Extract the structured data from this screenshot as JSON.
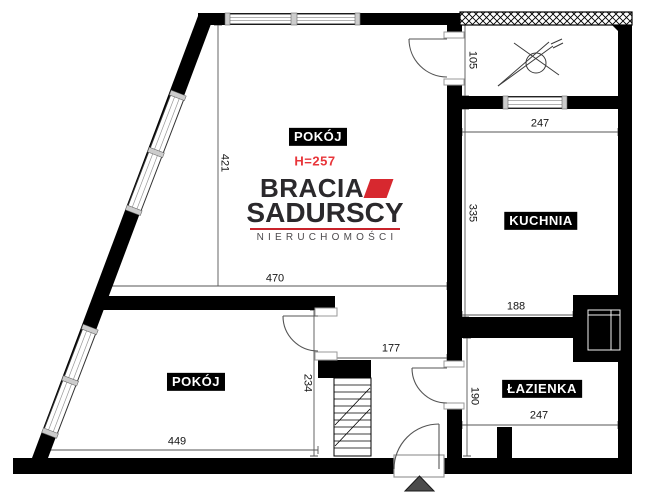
{
  "branding": {
    "line1": "BRACIA",
    "line2": "SADURSCY",
    "line3": "NIERUCHOMOŚCI"
  },
  "room_labels": {
    "room_top": "POKÓJ",
    "room_top_height_note": "H=257",
    "kitchen": "KUCHNIA",
    "bathroom": "ŁAZIENKA",
    "room_bottom": "POKÓJ"
  },
  "dimensions_cm": {
    "room_top_height": "421",
    "room_top_width": "470",
    "vent_corridor_height": "105",
    "kitchen_width": "247",
    "kitchen_height": "335",
    "bathroom_top_width": "188",
    "bathroom_height": "190",
    "bathroom_width": "247",
    "hall_passage_width": "177",
    "room_bottom_height": "234",
    "room_bottom_width": "449"
  },
  "colors": {
    "wall": "#000000",
    "brand_red": "#d7282f",
    "height_note_red": "#e8353a",
    "entrance_arrow_gray": "#4a4a4a"
  }
}
